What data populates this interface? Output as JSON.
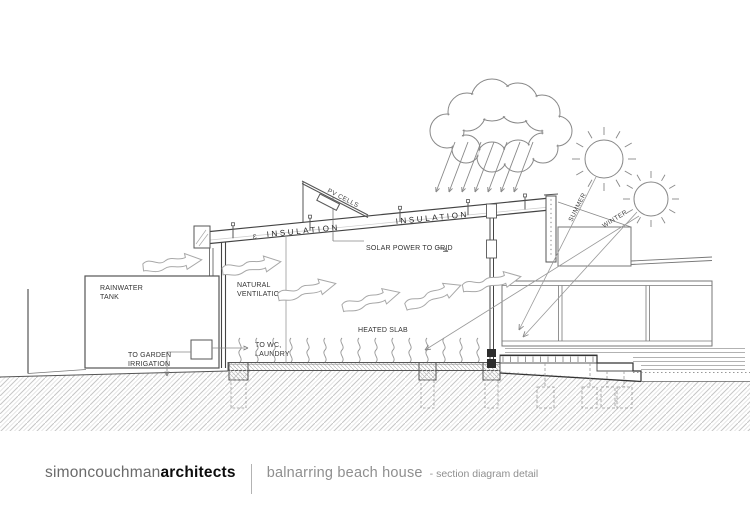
{
  "title_block": {
    "firm_regular": "simoncouchman",
    "firm_bold": "architects",
    "project_title": "balnarring beach house",
    "project_subtitle": "- section diagram detail"
  },
  "annotations": {
    "rainwater_tank": [
      "RAINWATER",
      "TANK"
    ],
    "to_garden_irrigation": [
      "TO GARDEN",
      "IRRIGATION"
    ],
    "to_wc_laundry": [
      "TO WC,",
      "LAUNDRY"
    ],
    "natural_ventilation": [
      "NATURAL",
      "VENTILATION"
    ],
    "heated_slab": "HEATED SLAB",
    "insulation_left": "INSULATION",
    "insulation_right": "INSULATION",
    "insulation_symbol": "Ɛ",
    "pv_cells": "PV CELLS",
    "solar_power_to_grid": "SOLAR POWER TO GRID",
    "summer": "SUMMER",
    "winter": "WINTER"
  },
  "counts": {
    "rain_arrows": 7,
    "heat_squiggles": 15,
    "sun_rays": 12
  },
  "colors": {
    "line_dark": "#3a3a3a",
    "line_mid": "#777777",
    "line_light": "#aaaaaa",
    "hatch": "#c9c9c9",
    "text": "#333333",
    "title_gray": "#8f8f8f"
  }
}
